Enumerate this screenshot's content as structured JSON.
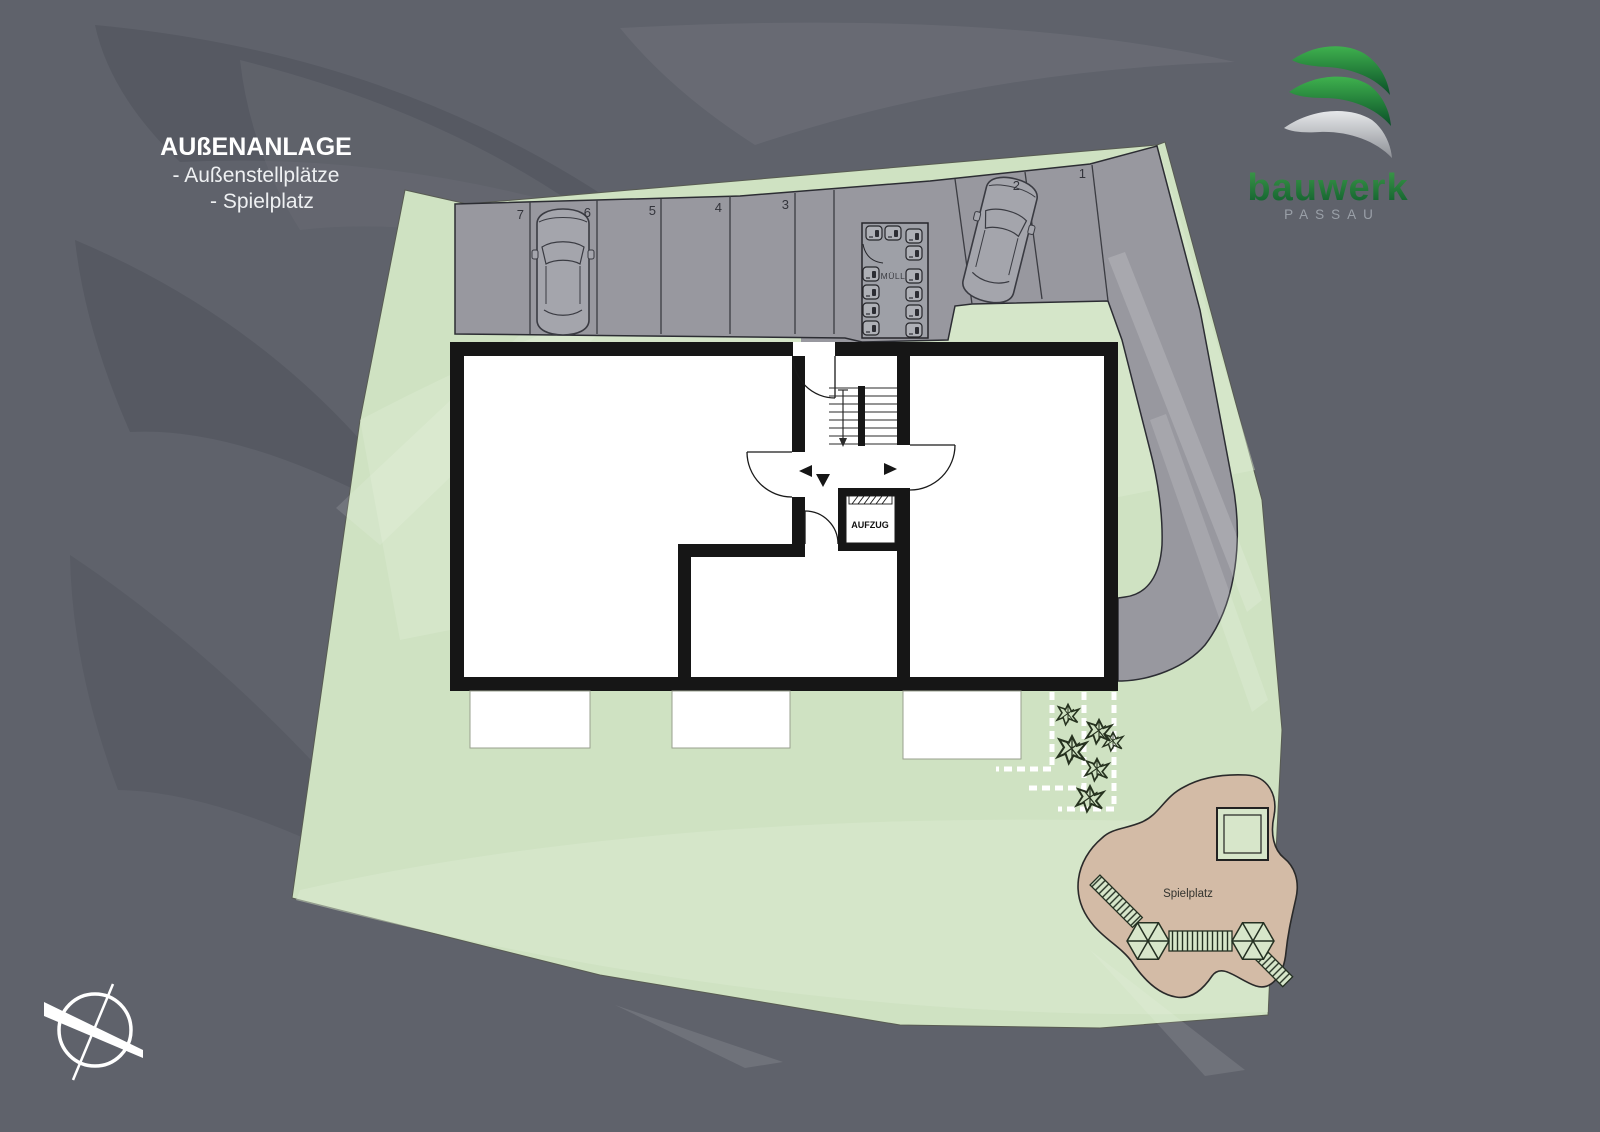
{
  "header": {
    "title": "AUßENANLAGE",
    "line1": "- Außenstellplätze",
    "line2": "- Spielplatz"
  },
  "logo": {
    "brand": "bauwerk",
    "city": "PASSAU"
  },
  "plan": {
    "parking_numbers": [
      "7",
      "6",
      "5",
      "4",
      "3",
      "2",
      "1"
    ],
    "waste_label": "MÜLL",
    "elevator_label": "AUFZUG",
    "playground_label": "Spielplatz",
    "colors": {
      "background": "#5f626b",
      "site_green": "#cfe2c2",
      "road_gray": "#98989f",
      "playground_tan": "#d3bba6",
      "building_wall": "#161616",
      "interior_white": "#ffffff",
      "logo_green_dark": "#0a4f28",
      "logo_green_light": "#35a84a",
      "logo_silver": "#c9ccd1"
    }
  }
}
